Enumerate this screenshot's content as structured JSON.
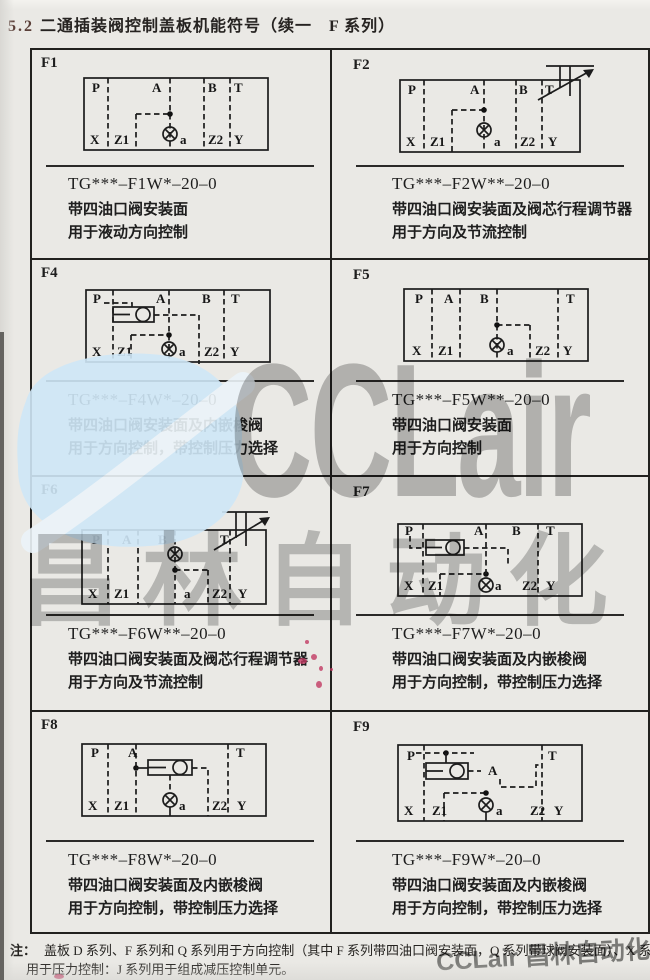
{
  "header": {
    "section": "5.2",
    "title": "二通插装阀控制盖板机能符号（续一　F 系列）"
  },
  "ports": {
    "P": "P",
    "A": "A",
    "B": "B",
    "T": "T",
    "X": "X",
    "Z1": "Z1",
    "Z2": "Z2",
    "Y": "Y",
    "a": "a"
  },
  "cells": [
    {
      "id": "F1",
      "code": "TG***–F1W*–20–0",
      "desc1": "带四油口阀安装面",
      "desc2": "用于液动方向控制"
    },
    {
      "id": "F2",
      "code": "TG***–F2W**–20–0",
      "desc1": "带四油口阀安装面及阀芯行程调节器",
      "desc2": "用于方向及节流控制"
    },
    {
      "id": "F4",
      "code": "TG***–F4W*–20–0",
      "desc1": "带四油口阀安装面及内嵌梭阀",
      "desc2": "用于方向控制，带控制压力选择"
    },
    {
      "id": "F5",
      "code": "TG***–F5W**–20–0",
      "desc1": "带四油口阀安装面",
      "desc2": "用于方向控制"
    },
    {
      "id": "F6",
      "code": "TG***–F6W**–20–0",
      "desc1": "带四油口阀安装面及阀芯行程调节器",
      "desc2": "用于方向及节流控制"
    },
    {
      "id": "F7",
      "code": "TG***–F7W*–20–0",
      "desc1": "带四油口阀安装面及内嵌梭阀",
      "desc2": "用于方向控制，带控制压力选择"
    },
    {
      "id": "F8",
      "code": "TG***–F8W*–20–0",
      "desc1": "带四油口阀安装面及内嵌梭阀",
      "desc2": "用于方向控制，带控制压力选择"
    },
    {
      "id": "F9",
      "code": "TG***–F9W*–20–0",
      "desc1": "带四油口阀安装面及内嵌梭阀",
      "desc2": "用于方向控制，带控制压力选择"
    }
  ],
  "note": {
    "label": "注：",
    "line1": "盖板 D 系列、F 系列和 Q 系列用于方向控制（其中 F 系列带四油口阀安装面，Q 系列带球阀安装面）、X 系列",
    "line2": "用于压力控制：J 系列用于组成减压控制单元。"
  },
  "watermark": {
    "latin": "CCLair",
    "cn": "昌林自动化",
    "footer": "CCLair 昌林自动化",
    "blue": "#cfe7f7",
    "gray": "#8d8d8d"
  }
}
